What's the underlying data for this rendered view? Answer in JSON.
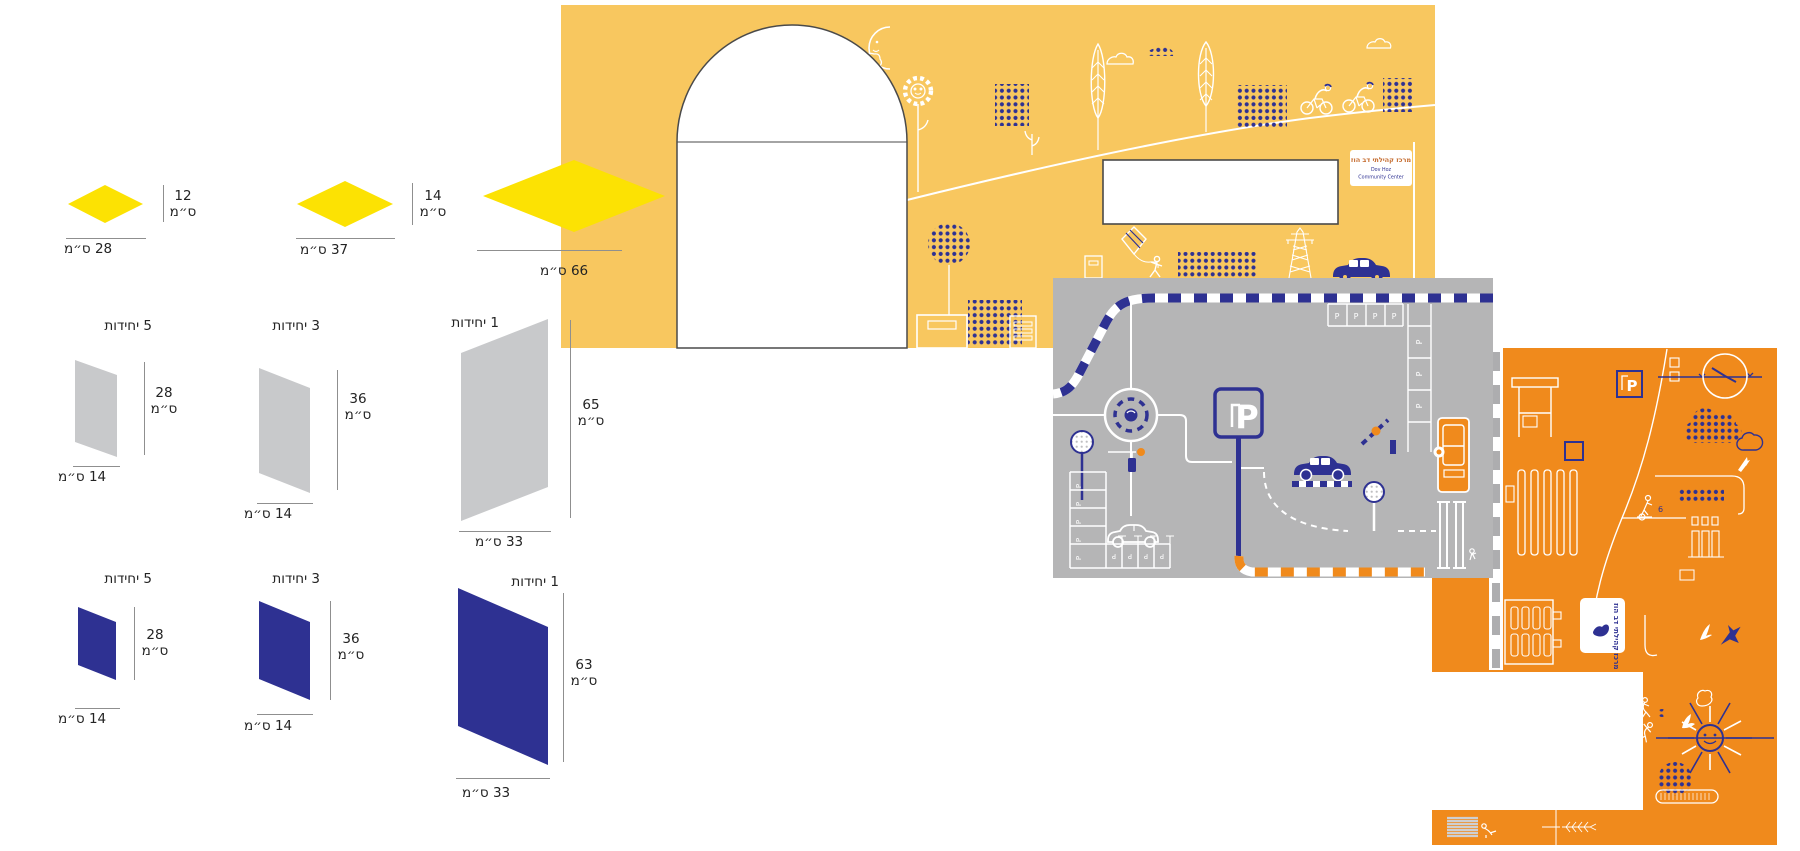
{
  "title": "Signage production spec – community center murals",
  "colors": {
    "panel_yellow": "#F8C75F",
    "diamond_yellow": "#FCE203",
    "panel_gray": "#B5B5B6",
    "shape_gray": "#C8C9CB",
    "brand_blue": "#2E3192",
    "panel_orange": "#F08A1C",
    "outline_dark": "#4A4A4A"
  },
  "spec": {
    "diamonds": {
      "items": [
        {
          "height_value": "12",
          "height_unit": "ס״מ",
          "width_label": "28 ס״מ"
        },
        {
          "height_value": "14",
          "height_unit": "ס״מ",
          "width_label": "37 ס״מ"
        },
        {
          "width_label": "66 ס״מ"
        }
      ]
    },
    "gray_row": {
      "items": [
        {
          "units_label": "5 יחידות",
          "height_value": "28",
          "height_unit": "ס״מ",
          "width_label": "14 ס״מ"
        },
        {
          "units_label": "3 יחידות",
          "height_value": "36",
          "height_unit": "ס״מ",
          "width_label": "14 ס״מ"
        },
        {
          "units_label": "1 יחידות",
          "height_value": "65",
          "height_unit": "ס״מ",
          "width_label": "33 ס״מ"
        }
      ]
    },
    "blue_row": {
      "items": [
        {
          "units_label": "5 יחידות",
          "height_value": "28",
          "height_unit": "ס״מ",
          "width_label": "14 ס״מ"
        },
        {
          "units_label": "3 יחידות",
          "height_value": "36",
          "height_unit": "ס״מ",
          "width_label": "14 ס״מ"
        },
        {
          "units_label": "1 יחידות",
          "height_value": "63",
          "height_unit": "ס״מ",
          "width_label": "33 ס״מ"
        }
      ]
    }
  },
  "yellow_mural": {
    "sign_line1": "מרכז קהילתי דב הוז",
    "sign_line2": "Dov Hoz",
    "sign_line3": "Community Center"
  },
  "gray_mural": {
    "parking_sign_letter": "P",
    "parking_letter": "P"
  },
  "orange_mural": {
    "card_text": "מרכז קהילתי דב הוז",
    "parking_sign_letter": "P",
    "figure_label": "6"
  }
}
